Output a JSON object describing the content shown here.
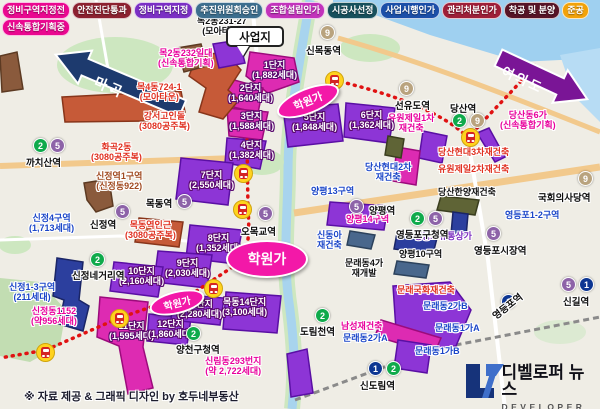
{
  "legend": {
    "row1": [
      {
        "label": "정비구역지정전",
        "color": "#ea0890"
      },
      {
        "label": "안전진단통과",
        "color": "#8c2130"
      },
      {
        "label": "정비구역지정",
        "color": "#7b2fc4"
      },
      {
        "label": "추진위원회승인",
        "color": "#3d6e8e"
      },
      {
        "label": "조합설립인가",
        "color": "#c233bb"
      },
      {
        "label": "시공사선정",
        "color": "#17505c"
      },
      {
        "label": "사업시행인가",
        "color": "#1c4fa8"
      },
      {
        "label": "관리처분인가",
        "color": "#9e1f38"
      },
      {
        "label": "착공 및 분양",
        "color": "#571426"
      },
      {
        "label": "준공",
        "color": "#f2a20a"
      }
    ],
    "row2": [
      {
        "label": "신속통합기획중",
        "color": "#ea0890"
      }
    ]
  },
  "callout": {
    "label": "사업지"
  },
  "arrows": {
    "left": "마곡",
    "right": "여의도"
  },
  "footer": {
    "credit": "※ 자료 제공 & 그래픽 디자인 by 호두네부동산"
  },
  "logo": {
    "title": "디벨로퍼 뉴스",
    "subtitle": "DEVELOPER NEWS"
  },
  "line_colors": {
    "1": "#0d3692",
    "2": "#0faa4b",
    "5": "#8d63a8",
    "9": "#b9a37e"
  },
  "map": {
    "parcel_colors": {
      "mag": {
        "fill": "#dd2bb2",
        "stroke": "#9c0b7c"
      },
      "pur": {
        "fill": "#8d35d6",
        "stroke": "#5a0fa4"
      },
      "red": {
        "fill": "#c65a38",
        "stroke": "#88351a"
      },
      "brn": {
        "fill": "#8a5a3c",
        "stroke": "#5c3a22"
      },
      "nvy": {
        "fill": "#2c3f9e",
        "stroke": "#1a2566"
      },
      "olv": {
        "fill": "#5f6436",
        "stroke": "#3a3e1e"
      },
      "stl": {
        "fill": "#49678c",
        "stroke": "#2c425c"
      }
    },
    "parcels": [
      {
        "id": "mokdong-1danji",
        "c": "mag",
        "pts": "250,52 294,58 299,82 268,93 246,76"
      },
      {
        "id": "mokdong-2danji",
        "c": "mag",
        "pts": "227,78 263,88 258,113 225,105"
      },
      {
        "id": "mokdong-3danji",
        "c": "mag",
        "pts": "227,108 268,112 262,140 229,136"
      },
      {
        "id": "mokdong-4danji",
        "c": "pur",
        "pts": "227,138 266,141 260,169 225,163"
      },
      {
        "id": "mokdong-5danji",
        "c": "pur",
        "pts": "283,108 338,104 343,141 288,147"
      },
      {
        "id": "mokdong-6danji",
        "c": "pur",
        "pts": "346,103 395,108 389,143 344,137"
      },
      {
        "id": "mokdong-7danji",
        "c": "pur",
        "pts": "181,158 233,163 228,205 176,199"
      },
      {
        "id": "mokdong-8danji",
        "c": "pur",
        "pts": "190,225 242,230 236,264 186,258"
      },
      {
        "id": "mokdong-9danji",
        "c": "pur",
        "pts": "158,251 212,255 207,288 154,282"
      },
      {
        "id": "mokdong-10danji",
        "c": "pur",
        "pts": "114,262 163,267 158,297 110,291"
      },
      {
        "id": "mokdong-11danji",
        "c": "mag",
        "pts": "100,297 148,302 143,347 153,388 128,394 119,346 97,337"
      },
      {
        "id": "mokdong-12danji",
        "c": "pur",
        "pts": "149,314 191,318 187,345 147,341"
      },
      {
        "id": "mokdong-13danji",
        "c": "pur",
        "pts": "173,294 224,298 220,325 171,320"
      },
      {
        "id": "mokdong-14danji",
        "c": "pur",
        "pts": "226,292 281,296 277,333 223,329"
      },
      {
        "id": "gangseo-goindol",
        "c": "red",
        "pts": "196,58 224,51 241,70 228,90 239,100 223,119 199,112 206,88 189,76"
      },
      {
        "id": "hwagok2dong",
        "c": "red",
        "pts": "62,97 181,91 185,112 150,112 148,121 65,122"
      },
      {
        "id": "mok4dong-724",
        "c": "brn",
        "pts": "177,48 201,44 207,66 184,72"
      },
      {
        "id": "mok2dong-232",
        "c": "pur",
        "pts": "213,44 239,40 245,63 219,68"
      },
      {
        "id": "sinjeongyeok-1",
        "c": "brn",
        "pts": "84,183 109,179 113,206 96,212 87,200"
      },
      {
        "id": "mokdongyeok-3080",
        "c": "red",
        "pts": "139,218 183,222 179,247 135,242"
      },
      {
        "id": "left-edge-zone",
        "c": "brn",
        "pts": "0,56 17,52 23,89 2,92"
      },
      {
        "id": "sinjeong-1-3",
        "c": "nvy",
        "pts": "57,258 83,262 79,300 89,306 83,331 59,324 64,300 53,296"
      },
      {
        "id": "dangsan-hyundai3",
        "c": "pur",
        "pts": "423,131 447,136 442,163 419,158"
      },
      {
        "id": "dangsan-dong6ga",
        "c": "pur",
        "pts": "477,133 489,128 505,157 495,162"
      },
      {
        "id": "dangsan-hanyang",
        "c": "olv",
        "pts": "441,196 479,200 475,215 437,210"
      },
      {
        "id": "yeongdeungpo-1-2",
        "c": "nvy",
        "pts": "453,212 468,214 466,237 451,234"
      },
      {
        "id": "yangpyeong-14",
        "c": "pur",
        "pts": "330,202 388,206 384,230 327,225"
      },
      {
        "id": "mullae-cluster",
        "c": "pur",
        "pts": "393,286 450,282 471,310 456,346 420,350 396,330"
      },
      {
        "id": "mullae-2gaA",
        "c": "mag",
        "pts": "381,320 441,338 434,354 375,336"
      },
      {
        "id": "mullae-1gaB",
        "c": "pur",
        "pts": "398,340 431,345 427,373 394,368"
      },
      {
        "id": "sindorim-block",
        "c": "pur",
        "pts": "287,354 307,349 313,393 291,397"
      },
      {
        "id": "mullae-4ga",
        "c": "stl",
        "pts": "350,231 375,235 371,249 347,245"
      },
      {
        "id": "yeongdeungpo-yutong",
        "c": "nvy",
        "pts": "397,233 437,238 433,254 394,249"
      },
      {
        "id": "yangpyeong-10",
        "c": "stl",
        "pts": "397,261 429,265 426,278 394,274"
      },
      {
        "id": "dangsan-hyundai2",
        "c": "mag",
        "pts": "397,147 420,151 416,185 393,181"
      },
      {
        "id": "yuwon-jeil1",
        "c": "olv",
        "pts": "388,136 404,139 401,158 385,155"
      }
    ],
    "routes": [
      "M334,80 C375,90 432,106 463,133",
      "M477,128 C495,108 516,88 535,65",
      "M247,140 L248,210 C250,235 248,250 240,262 L195,292 L119,318 L46,350 L0,358"
    ],
    "trains": [
      [
        334,
        80
      ],
      [
        470,
        137
      ],
      [
        243,
        173
      ],
      [
        242,
        209
      ],
      [
        213,
        288
      ],
      [
        119,
        318
      ],
      [
        45,
        352
      ]
    ],
    "hakwon_label": "학원가",
    "ellipses": [
      {
        "x": 265,
        "y": 257,
        "w": 78,
        "h": 34,
        "rot": 0,
        "fs": 14
      },
      {
        "x": 306,
        "y": 99,
        "w": 62,
        "h": 22,
        "rot": -22,
        "fs": 11
      },
      {
        "x": 175,
        "y": 300,
        "w": 52,
        "h": 19,
        "rot": -14,
        "fs": 10
      }
    ],
    "labels": [
      {
        "t": "목2동231-27",
        "t2": "(모아타운)",
        "x": 197,
        "y": 16,
        "c": "#111111"
      },
      {
        "t": "목2동232일대",
        "t2": "(신속통합기획)",
        "x": 158,
        "y": 48,
        "c": "#e8009c"
      },
      {
        "t": "목4동724-1",
        "t2": "(모아타운)",
        "x": 137,
        "y": 82,
        "c": "#e03020"
      },
      {
        "t": "강서고인돌",
        "t2": "(3080공주복)",
        "x": 139,
        "y": 111,
        "c": "#e03020"
      },
      {
        "t": "화곡2동",
        "t2": "(3080공주복)",
        "x": 91,
        "y": 142,
        "c": "#e03020"
      },
      {
        "t": "신정역1구역",
        "t2": "(신정동922)",
        "x": 96,
        "y": 171,
        "c": "#a04a20"
      },
      {
        "t": "목동역인근",
        "t2": "(3080공주복)",
        "x": 125,
        "y": 220,
        "c": "#e03020"
      },
      {
        "t": "신정4구역",
        "t2": "(1,713세대)",
        "x": 29,
        "y": 213,
        "c": "#1b46c8"
      },
      {
        "t": "신정1-3구역",
        "t2": "(211세대)",
        "x": 9,
        "y": 282,
        "c": "#1b46c8"
      },
      {
        "t": "신정동1152",
        "t2": "(약956세대)",
        "x": 31,
        "y": 306,
        "c": "#e8009c"
      },
      {
        "t": "당산동6가",
        "t2": "(신속통합기획)",
        "x": 500,
        "y": 110,
        "c": "#e8009c"
      },
      {
        "t": "유원제일1차",
        "t2": "재건축",
        "x": 388,
        "y": 113,
        "c": "#e8009c"
      },
      {
        "t": "당산현대2차",
        "t2": "재건축",
        "x": 365,
        "y": 162,
        "c": "#1b46c8"
      },
      {
        "t": "당산현대3차재건축",
        "x": 438,
        "y": 147,
        "c": "#e03020"
      },
      {
        "t": "유원제일2차재건축",
        "x": 438,
        "y": 164,
        "c": "#e03020"
      },
      {
        "t": "당산한양재건축",
        "x": 438,
        "y": 187,
        "c": "#111111"
      },
      {
        "t": "양평13구역",
        "x": 311,
        "y": 186,
        "c": "#1b46c8"
      },
      {
        "t": "양평14구역",
        "x": 346,
        "y": 214,
        "c": "#e8009c"
      },
      {
        "t": "신동아",
        "t2": "재건축",
        "x": 317,
        "y": 230,
        "c": "#1b46c8"
      },
      {
        "t": "영등포1-2구역",
        "x": 505,
        "y": 210,
        "c": "#1b46c8"
      },
      {
        "t": "영등포유통상가",
        "x": 414,
        "y": 231,
        "c": "#7d2fc0"
      },
      {
        "t": "양평10구역",
        "x": 399,
        "y": 249,
        "c": "#111111"
      },
      {
        "t": "문래동4가",
        "t2": "재개발",
        "x": 345,
        "y": 258,
        "c": "#111111"
      },
      {
        "t": "문래국화재건축",
        "x": 397,
        "y": 285,
        "c": "#e03020"
      },
      {
        "t": "문래동2가B",
        "x": 423,
        "y": 301,
        "c": "#1b46c8"
      },
      {
        "t": "문래동1가A",
        "x": 435,
        "y": 323,
        "c": "#1b46c8"
      },
      {
        "t": "남성재건축",
        "x": 341,
        "y": 321,
        "c": "#e8009c"
      },
      {
        "t": "문래동2가A",
        "x": 343,
        "y": 333,
        "c": "#1b46c8"
      },
      {
        "t": "문래동1가B",
        "x": 415,
        "y": 346,
        "c": "#1b46c8"
      },
      {
        "t": "신림동293번지",
        "t2": "(약 2,722세대)",
        "x": 205,
        "y": 356,
        "c": "#e8009c"
      }
    ],
    "danji_labels": [
      {
        "t": "1단지",
        "t2": "(1,882세대)",
        "x": 252,
        "y": 60
      },
      {
        "t": "2단지",
        "t2": "(1,640세대)",
        "x": 228,
        "y": 83
      },
      {
        "t": "3단지",
        "t2": "(1,588세대)",
        "x": 229,
        "y": 111
      },
      {
        "t": "4단지",
        "t2": "(1,382세대)",
        "x": 229,
        "y": 140
      },
      {
        "t": "5단지",
        "t2": "(1,848세대)",
        "x": 292,
        "y": 112
      },
      {
        "t": "6단지",
        "t2": "(1,362세대)",
        "x": 349,
        "y": 110
      },
      {
        "t": "7단지",
        "t2": "(2,550세대)",
        "x": 189,
        "y": 170
      },
      {
        "t": "8단지",
        "t2": "(1,352세대)",
        "x": 196,
        "y": 233
      },
      {
        "t": "9단지",
        "t2": "(2,030세대)",
        "x": 165,
        "y": 258
      },
      {
        "t": "10단지",
        "t2": "(2,160세대)",
        "x": 119,
        "y": 266
      },
      {
        "t": "11단지",
        "t2": "(1,595세대)",
        "x": 109,
        "y": 321
      },
      {
        "t": "12단지",
        "t2": "(1,860세대)",
        "x": 148,
        "y": 319
      },
      {
        "t": "13단지",
        "t2": "(2,280세대)",
        "x": 177,
        "y": 299
      },
      {
        "t": "목동14단지",
        "t2": "(3,100세대)",
        "x": 222,
        "y": 297
      }
    ],
    "stations": [
      {
        "name": "까치산역",
        "badges": [
          [
            "2",
            33,
            138
          ],
          [
            "5",
            50,
            138
          ]
        ],
        "tx": 26,
        "ty": 155
      },
      {
        "name": "신정역",
        "badges": [
          [
            "5",
            115,
            204
          ]
        ],
        "tx": 90,
        "ty": 217
      },
      {
        "name": "목동역",
        "badges": [
          [
            "5",
            177,
            194
          ]
        ],
        "tx": 146,
        "ty": 196
      },
      {
        "name": "오목교역",
        "badges": [
          [
            "5",
            258,
            206
          ]
        ],
        "tx": 241,
        "ty": 224
      },
      {
        "name": "신정네거리역",
        "badges": [
          [
            "2",
            90,
            252
          ]
        ],
        "tx": 72,
        "ty": 268
      },
      {
        "name": "양천구청역",
        "badges": [
          [
            "2",
            186,
            326
          ]
        ],
        "tx": 176,
        "ty": 342
      },
      {
        "name": "도림천역",
        "badges": [
          [
            "2",
            315,
            308
          ]
        ],
        "tx": 300,
        "ty": 324
      },
      {
        "name": "신도림역",
        "badges": [
          [
            "1",
            368,
            361
          ],
          [
            "2",
            386,
            361
          ]
        ],
        "tx": 360,
        "ty": 378
      },
      {
        "name": "신목동역",
        "badges": [
          [
            "9",
            320,
            25
          ]
        ],
        "tx": 306,
        "ty": 43
      },
      {
        "name": "선유도역",
        "badges": [
          [
            "9",
            399,
            81
          ]
        ],
        "tx": 395,
        "ty": 98
      },
      {
        "name": "당산역",
        "badges": [
          [
            "2",
            452,
            113
          ],
          [
            "9",
            470,
            113
          ]
        ],
        "tx": 450,
        "ty": 101
      },
      {
        "name": "국회의사당역",
        "badges": [
          [
            "9",
            578,
            171
          ]
        ],
        "tx": 538,
        "ty": 190
      },
      {
        "name": "양평역",
        "badges": [
          [
            "5",
            349,
            199
          ]
        ],
        "tx": 369,
        "ty": 203
      },
      {
        "name": "영등포구청역",
        "badges": [
          [
            "2",
            410,
            211
          ],
          [
            "5",
            428,
            211
          ]
        ],
        "tx": 396,
        "ty": 227
      },
      {
        "name": "영등포시장역",
        "badges": [
          [
            "5",
            486,
            226
          ]
        ],
        "tx": 474,
        "ty": 243
      },
      {
        "name": "영등포역",
        "badges": [
          [
            "1",
            501,
            294
          ]
        ],
        "tx": 489,
        "ty": 311,
        "rot": -38
      },
      {
        "name": "신길역",
        "badges": [
          [
            "5",
            561,
            277
          ],
          [
            "1",
            579,
            277
          ]
        ],
        "tx": 563,
        "ty": 294
      }
    ]
  }
}
